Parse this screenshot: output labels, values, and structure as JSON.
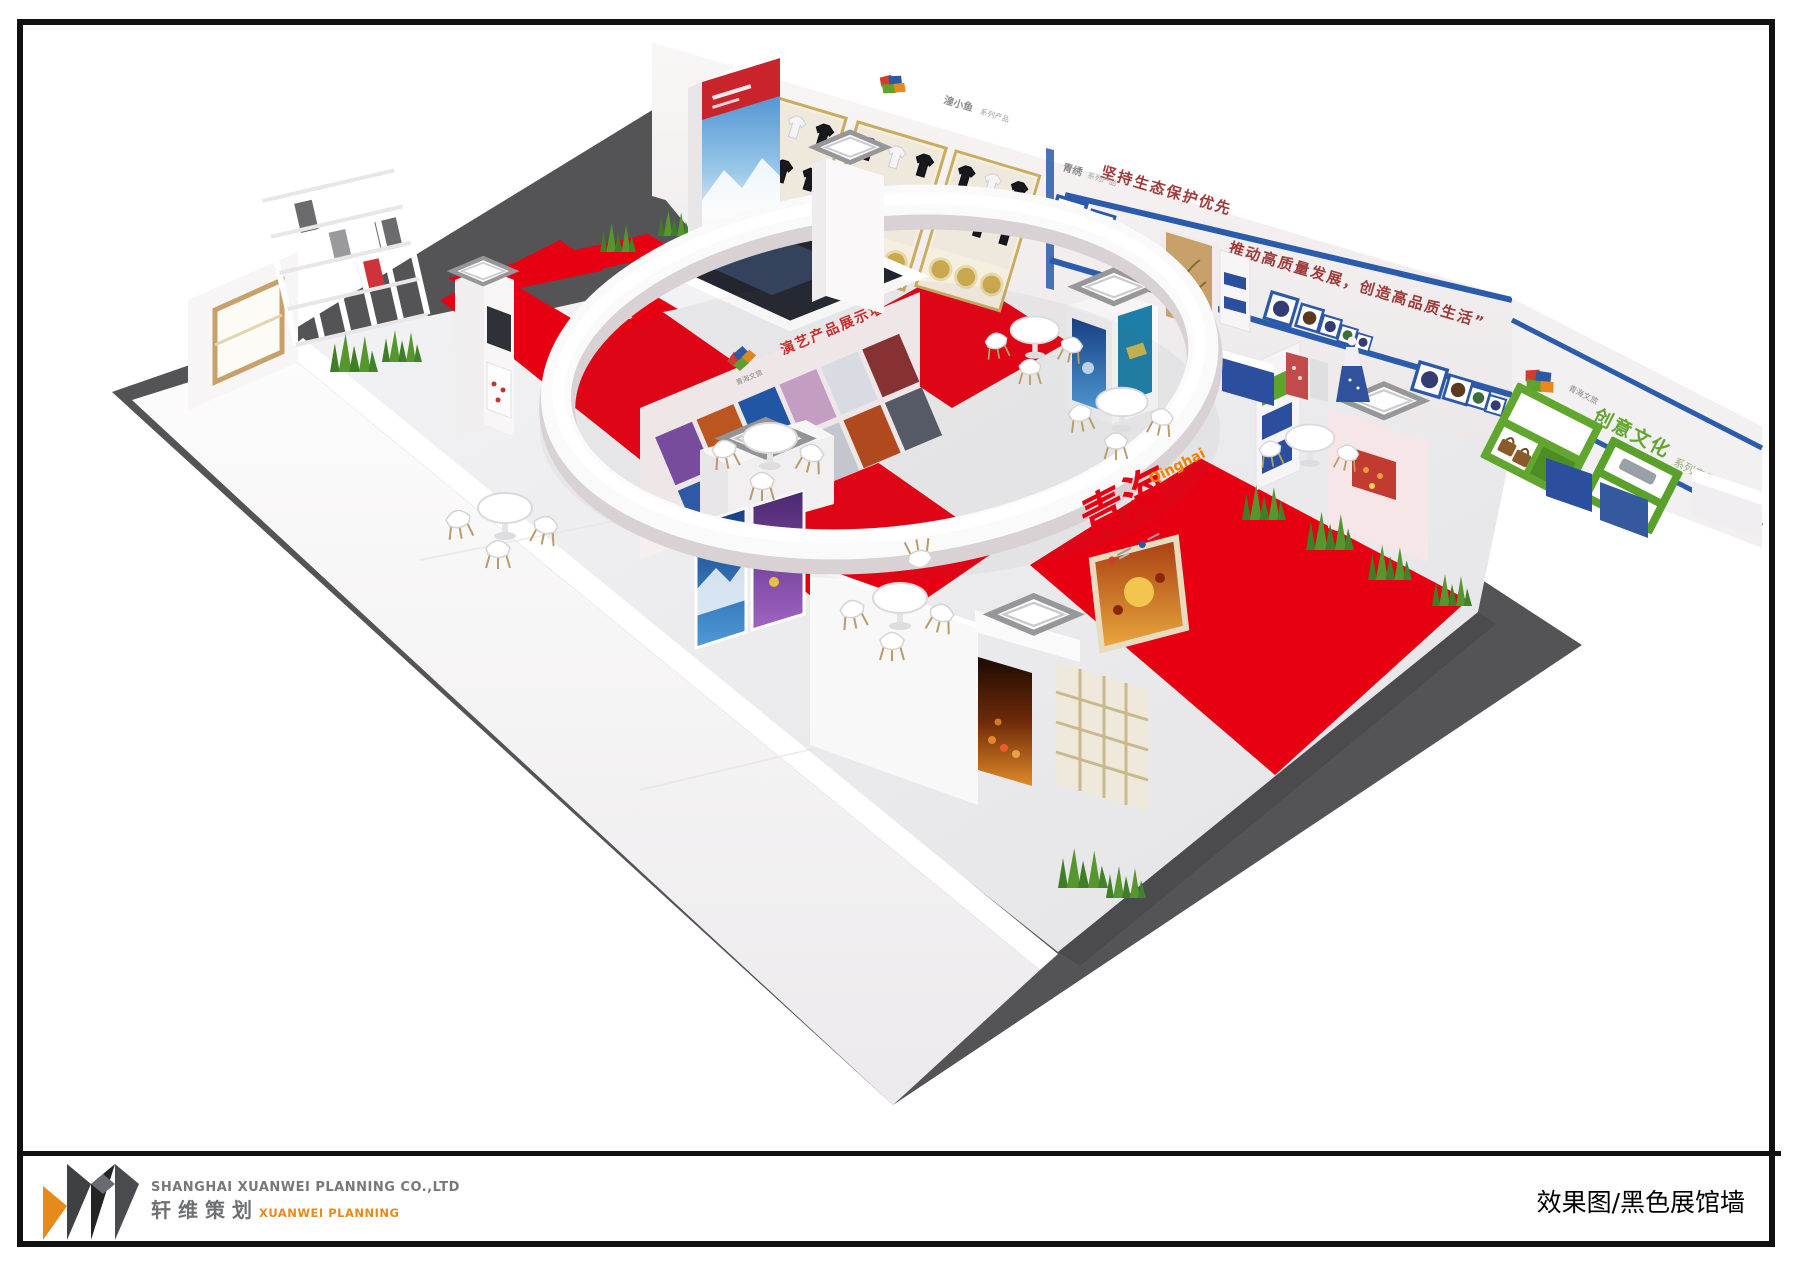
{
  "footer": {
    "company_en": "SHANGHAI XUANWEI PLANNING CO.,LTD",
    "company_cn": "轩维策划",
    "brand_en": "XUANWEI PLANNING",
    "caption": "效果图/黑色展馆墙"
  },
  "scene": {
    "colors": {
      "mat": "#545457",
      "floor_light": "#efeff1",
      "carpet_red": "#e60012",
      "wall_white": "#f8f6f7",
      "stripe_blue": "#2a5cab",
      "slogan_red": "#9d3b3b",
      "shelf_green": "#61a62e",
      "frame_blue": "#2b59a8",
      "bench_blue": "#2b4f9e",
      "wood": "#c8a06a",
      "accent_orange": "#f08300"
    },
    "back_wall": {
      "slogan_line1": "坚持生态保护优先",
      "slogan_line2": "推动高质量发展，创造高品质生活”",
      "sign1_brand": "湟小鱼",
      "sign1_series": "系列产品",
      "sign2_brand": "青绣",
      "sign2_series": "系列产品"
    },
    "ring": {
      "calligraphy": "青海",
      "pinyin": "Qinghai"
    },
    "center_display": {
      "title": "演艺产品展示墙",
      "logo_label": "青海文旅"
    },
    "right_wall": {
      "title": "创意文化",
      "subtitle": "系列产品",
      "logo_label": "青海文旅"
    }
  }
}
